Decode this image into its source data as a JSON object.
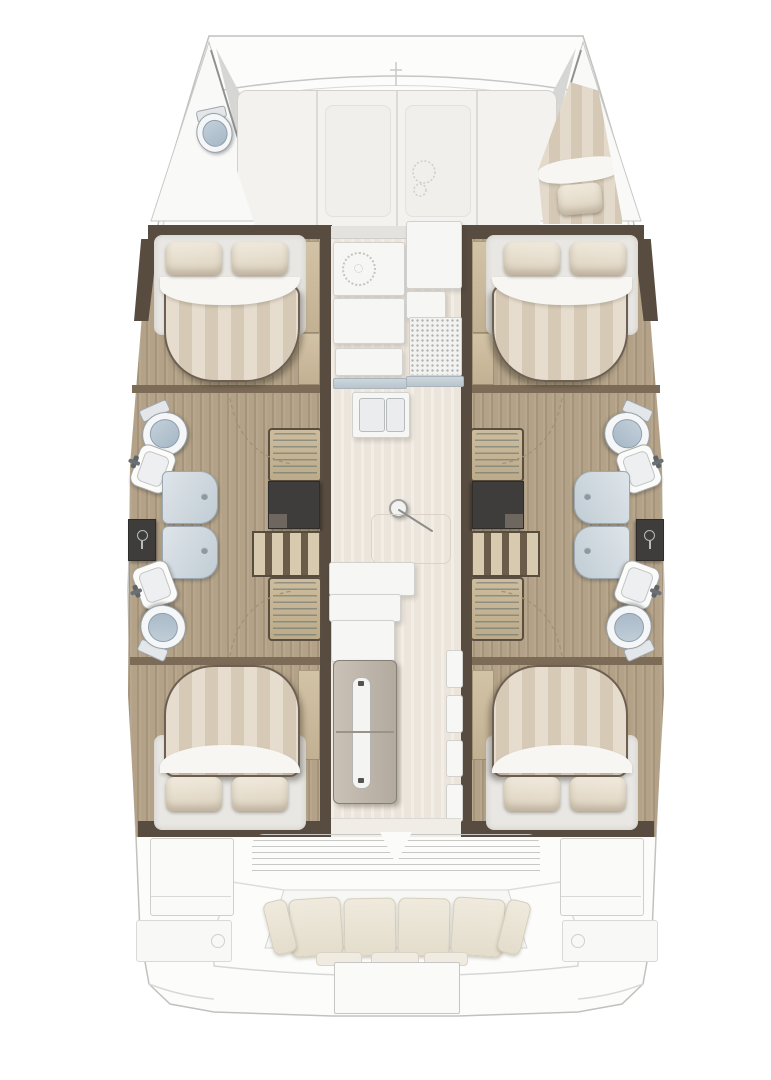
{
  "meta": {
    "title": "Catamaran interior deck plan",
    "view": "top-down floor plan",
    "orientation": "bow-up"
  },
  "palette": {
    "hull_outline": "#c1c1bf",
    "deck_white": "#fbfbfa",
    "wood_floor": "#b3a287",
    "wall_dark_brown": "#584c41",
    "wall_trim_brown": "#7c6b57",
    "light_wood": "#cdbda0",
    "bed_stripe_light": "#e6ddcf",
    "bed_stripe_dark": "#d6cab7",
    "pillow_cream": "#ece3d2",
    "sheet_white": "#f7f6f3",
    "toilet_lid_blue": "#b5c3d0",
    "shower_panel_blue": "#ccd5dc",
    "charcoal_unit": "#3e3d3b",
    "saloon_floor_beige": "#ece5db",
    "counter_white": "#f6f6f5",
    "counter_edge_blue": "#c3cdd4",
    "cushion_cream": "#ebe6d8",
    "steps_wood": "#c8b796"
  },
  "areas": {
    "bow": {
      "label": "Foredeck and bows",
      "forward_cockpit": {
        "label": "Forward cockpit sun lounge",
        "panel_count": 4
      },
      "port_forepeak": {
        "label": "Port forepeak head",
        "fixture": "marine-toilet"
      },
      "starboard_forepeak": {
        "label": "Starboard forepeak berth",
        "fixture": "single-berth",
        "pillow_count": 1
      }
    },
    "port_hull": {
      "label": "Port hull",
      "forward_cabin": {
        "label": "Forward double cabin",
        "bed": "island-double-bed",
        "pillow_count": 2
      },
      "forward_bathroom": {
        "label": "Forward bathroom",
        "fixtures": [
          "toilet",
          "washbasin"
        ]
      },
      "shower": {
        "label": "Shower cubicle",
        "panel_count": 2
      },
      "utility_locker": {
        "label": "Utility locker"
      },
      "aft_bathroom": {
        "label": "Aft bathroom",
        "fixtures": [
          "washbasin",
          "toilet"
        ]
      },
      "companionway": {
        "label": "Companionway steps",
        "step_flights": 2,
        "storage": [
          "locker",
          "shelf-unit"
        ]
      },
      "aft_cabin": {
        "label": "Aft double cabin",
        "bed": "island-double-bed",
        "pillow_count": 2
      }
    },
    "starboard_hull": {
      "label": "Starboard hull",
      "forward_cabin": {
        "label": "Forward double cabin",
        "bed": "island-double-bed",
        "pillow_count": 2
      },
      "forward_bathroom": {
        "label": "Forward bathroom",
        "fixtures": [
          "toilet",
          "washbasin"
        ]
      },
      "shower": {
        "label": "Shower cubicle",
        "panel_count": 2
      },
      "utility_locker": {
        "label": "Utility locker"
      },
      "aft_bathroom": {
        "label": "Aft bathroom",
        "fixtures": [
          "washbasin",
          "toilet"
        ]
      },
      "companionway": {
        "label": "Companionway steps",
        "step_flights": 2,
        "storage": [
          "locker",
          "shelf-unit"
        ]
      },
      "aft_cabin": {
        "label": "Aft double cabin",
        "bed": "island-double-bed",
        "pillow_count": 2
      }
    },
    "saloon": {
      "label": "Saloon and galley",
      "galley": {
        "label": "Galley",
        "fixtures": [
          "cooktop",
          "worktop",
          "double-sink",
          "drainer-grid"
        ]
      },
      "mast_post": {
        "label": "Mast compression post"
      },
      "floor_hatch": {
        "label": "Floor hatch"
      },
      "seating": {
        "label": "Saloon seating"
      },
      "fridge": {
        "label": "Fridge-freezer column",
        "door_count": 2
      },
      "side_bench": {
        "label": "Side bench",
        "segment_count": 4
      }
    },
    "stern": {
      "label": "Aft cockpit and platform",
      "aft_door": {
        "label": "Louvered aft door"
      },
      "cockpit_bench": {
        "label": "Cockpit bench",
        "cushion_count": 4
      },
      "side_lockers": {
        "label": "Cockpit side lockers",
        "count": 2
      },
      "swim_platform": {
        "label": "Swim platform"
      }
    }
  }
}
